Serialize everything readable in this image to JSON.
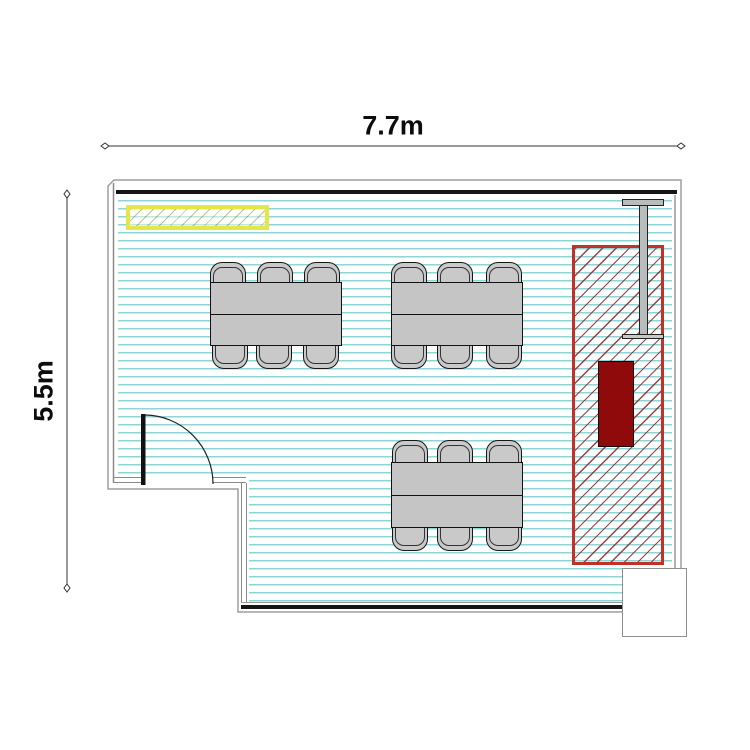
{
  "meta": {
    "type": "floor-plan",
    "room_shape": "L-shaped rectangular room with bottom-left notch",
    "units": "m"
  },
  "dimensions": {
    "width_label": "7.7m",
    "height_label": "5.5m"
  },
  "inventory": {
    "tables": 3,
    "chairs_per_table": 6,
    "chairs_total": 18,
    "doors": 1,
    "columns": 1
  },
  "zones": {
    "yellow_fixture": "yellow hatched wall fixture (top-left)",
    "red_zone": "red diagonal-hatched zone (right side)",
    "dark_red_unit": "dark red equipment block inside red zone",
    "beam": "I-beam / column profile at top right",
    "recess": "white bump-out at bottom-right corner"
  },
  "colors": {
    "floor_hatch_line": "#8fd4d6",
    "floor_background": "#fdffff",
    "wall": "#151515",
    "outline": "#9e9e9e",
    "yellow_border": "#e4e74a",
    "red_zone_border": "#c23028",
    "red_hatch_line": "#962a2a",
    "dark_red_fill": "#8f0b0b",
    "furniture_gray": "#c5c5c5",
    "chair_gray": "#c9c9c9",
    "beam_gray": "#b9bcbc",
    "dimension_text": "#0c0c0c"
  }
}
